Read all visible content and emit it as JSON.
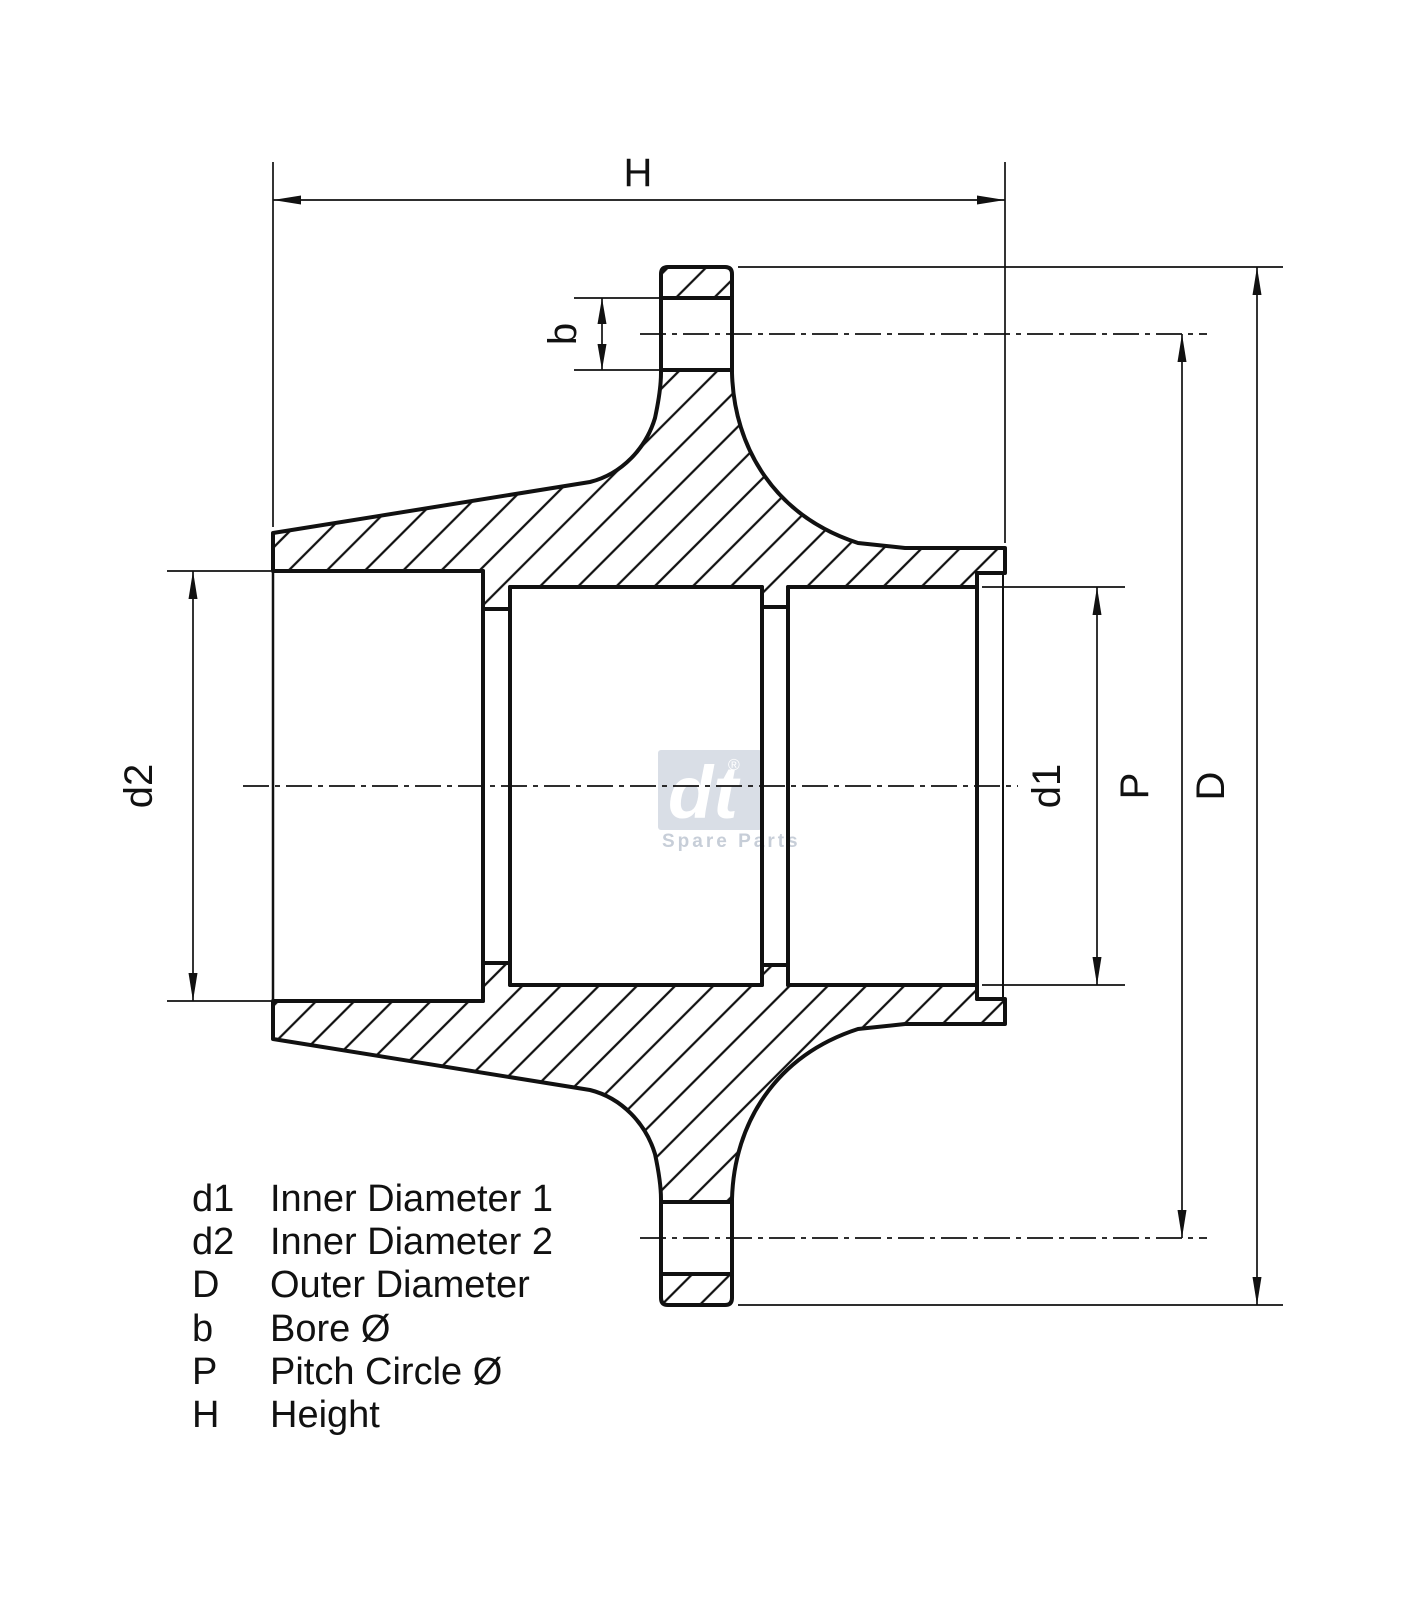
{
  "drawing": {
    "type": "technical-cross-section",
    "part": "wheel hub",
    "colors": {
      "line": "#111111",
      "background": "#ffffff",
      "watermark_box": "#d9dee6",
      "watermark_text": "#c7ced8"
    },
    "dimensions": {
      "height_label": "H",
      "bore_label": "b",
      "inner_diameter_1_label": "d1",
      "inner_diameter_2_label": "d2",
      "pitch_circle_label": "P",
      "outer_diameter_label": "D"
    },
    "legend": {
      "rows": [
        {
          "symbol": "d1",
          "label": "Inner Diameter 1"
        },
        {
          "symbol": "d2",
          "label": "Inner Diameter 2"
        },
        {
          "symbol": "D",
          "label": "Outer Diameter"
        },
        {
          "symbol": "b",
          "label": "Bore Ø"
        },
        {
          "symbol": "P",
          "label": "Pitch Circle Ø"
        },
        {
          "symbol": "H",
          "label": "Height"
        }
      ]
    },
    "watermark": {
      "logo": "dt",
      "registered": "®",
      "subtitle": "Spare Parts"
    }
  }
}
